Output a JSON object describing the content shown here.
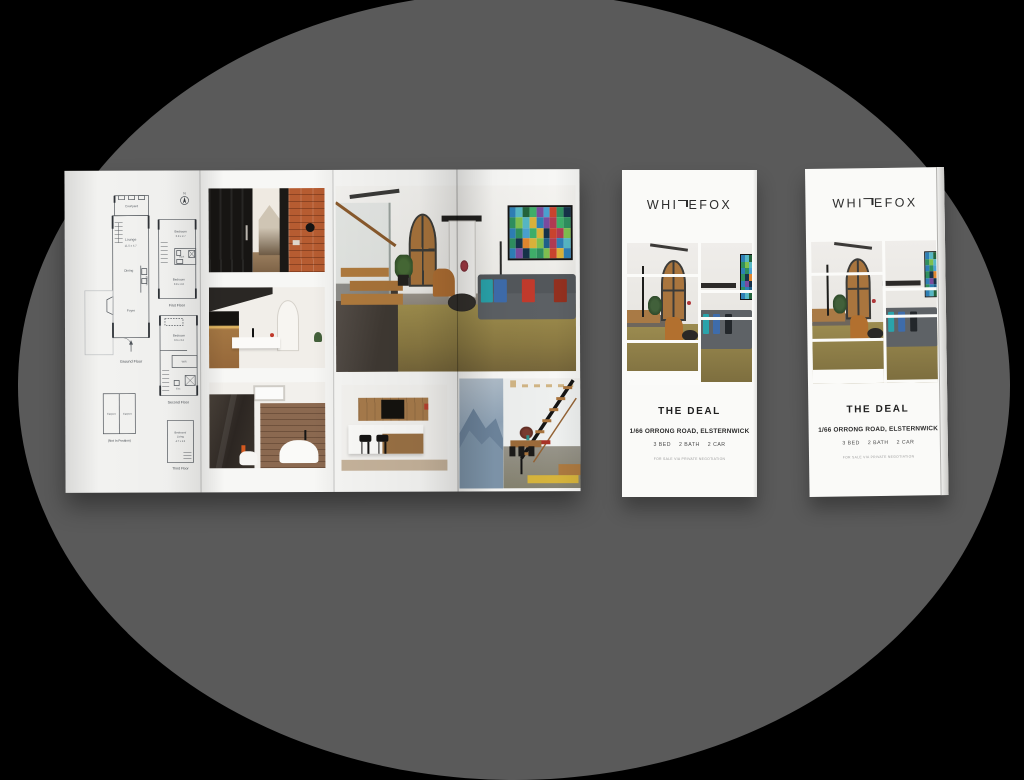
{
  "colors": {
    "background": "#000000",
    "backdrop_ellipse": "#5a5a5a",
    "brand_text": "#2d2d2d",
    "art_palette": [
      "#2e7fb5",
      "#3fae6a",
      "#c8432e",
      "#e0862f",
      "#1f5f8a",
      "#56b7c4",
      "#7a4b9e",
      "#2f8f5f",
      "#d9b23a",
      "#b03a52",
      "#23643c",
      "#4aa0d0",
      "#16324a",
      "#7fbf4f"
    ]
  },
  "open_brochure": {
    "floorplan": {
      "compass_n": "N",
      "ground": {
        "courtyard": "Courtyard",
        "lounge": "Lounge",
        "lounge_dims": "11.5 x 4.7",
        "dining": "Dining",
        "kitchen": "Kitchen",
        "foyer": "Foyer",
        "caption": "Ground Floor"
      },
      "first": {
        "bed1": "Bedroom",
        "bed1_dims": "3.9 x 2.7",
        "bath": "Bath",
        "bed2": "Bedroom",
        "bed2_dims": "3.8 x 2.8",
        "caption": "First Floor"
      },
      "second": {
        "bed": "Bedroom",
        "bed_dims": "3.6 x 3.2",
        "wir": "WIR",
        "ens": "Ens",
        "caption": "Second Floor"
      },
      "carport": {
        "left": "Carport",
        "right": "Carport",
        "caption": "(Not In Position)"
      },
      "third": {
        "line1": "Bedroom/",
        "line2": "Living",
        "dims": "4.7 x 3.5",
        "caption": "Third Floor"
      }
    }
  },
  "cover": {
    "brand_pre": "WHI",
    "brand_t": "T",
    "brand_post": "EFOX",
    "title": "THE DEAL",
    "address": "1/66 ORRONG ROAD, ELSTERNWICK",
    "specs": [
      "3 BED",
      "2 BATH",
      "2 CAR"
    ],
    "footnote": "FOR SALE VIA PRIVATE NEGOTIATION"
  }
}
